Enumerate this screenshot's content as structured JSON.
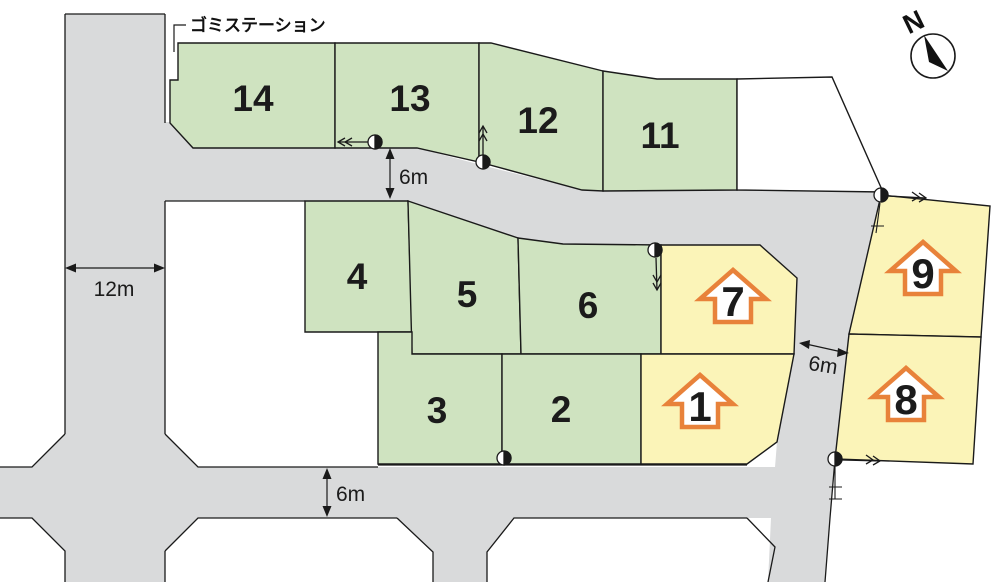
{
  "colors": {
    "green": "#cfe3c0",
    "yellow": "#fbf4b8",
    "road": "#d9dadb",
    "white": "#ffffff",
    "outline": "#1a1a1a",
    "house": "#e8823a"
  },
  "garbage_station": {
    "label": "ゴミステーション"
  },
  "compass": {
    "label": "N"
  },
  "dimensions": [
    {
      "label": "12m",
      "location": "left-road-width"
    },
    {
      "label": "6m",
      "location": "upper-road-width"
    },
    {
      "label": "6m",
      "location": "lower-road-width"
    },
    {
      "label": "6m",
      "location": "right-road-width"
    }
  ],
  "lots": [
    {
      "number": "14",
      "type": "green"
    },
    {
      "number": "13",
      "type": "green"
    },
    {
      "number": "12",
      "type": "green"
    },
    {
      "number": "11",
      "type": "green"
    },
    {
      "number": "4",
      "type": "green"
    },
    {
      "number": "5",
      "type": "green"
    },
    {
      "number": "6",
      "type": "green"
    },
    {
      "number": "3",
      "type": "green"
    },
    {
      "number": "2",
      "type": "green"
    },
    {
      "number": "7",
      "type": "yellow-sold-house"
    },
    {
      "number": "1",
      "type": "yellow-sold-house"
    },
    {
      "number": "9",
      "type": "yellow-sold-house"
    },
    {
      "number": "8",
      "type": "yellow-sold-house"
    },
    {
      "number": "",
      "type": "white-unnumbered"
    }
  ]
}
